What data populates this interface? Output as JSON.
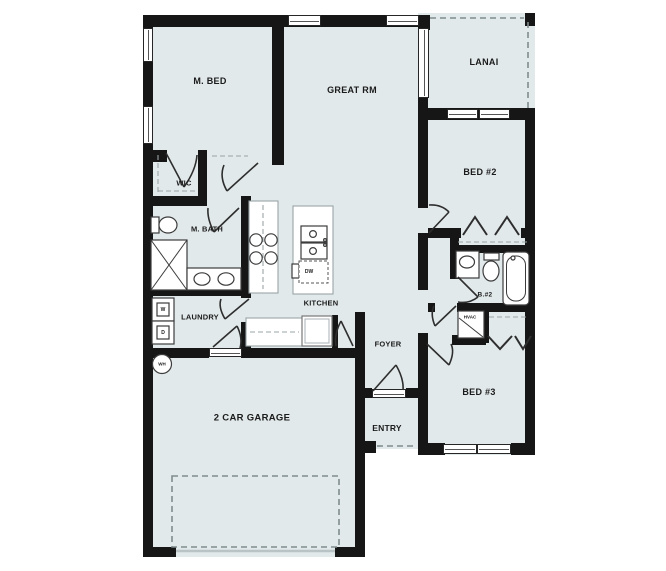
{
  "colors": {
    "floor": "#e2e9eb",
    "wall": "#161616",
    "dash": "#7f8c8e",
    "fixture_line": "#3c3c3c"
  },
  "rooms": {
    "m_bed": "M. BED",
    "great_rm": "GREAT RM",
    "lanai": "LANAI",
    "bed2": "BED #2",
    "wic": "WIC",
    "m_bath": "M. BATH",
    "kitchen": "KITCHEN",
    "laundry": "LAUNDRY",
    "bath2": "B.#2",
    "foyer": "FOYER",
    "bed3": "BED #3",
    "entry": "ENTRY",
    "garage": "2 CAR GARAGE"
  },
  "fixtures": {
    "washer": "W",
    "dryer": "D",
    "water_heater": "WH",
    "dishwasher": "DW",
    "hvac": "HVAC"
  }
}
